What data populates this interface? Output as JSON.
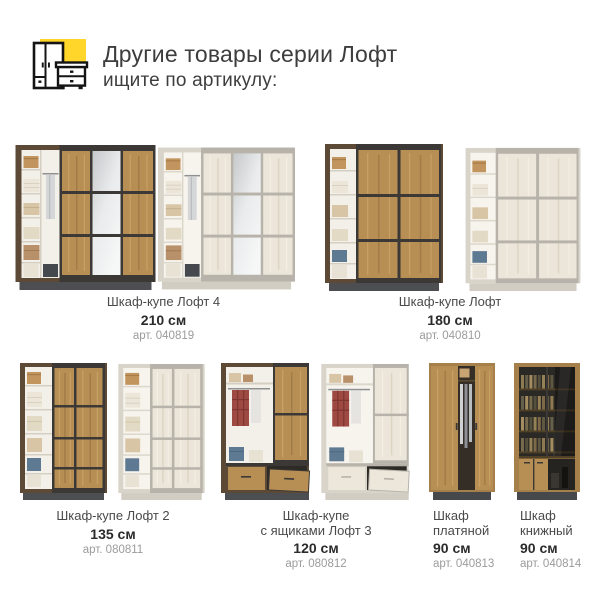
{
  "header": {
    "title": "Другие товары серии Лофт",
    "subtitle": "ищите по артикулу:",
    "icon": "wardrobe-and-dresser-icon"
  },
  "products": [
    {
      "name_lines": [
        "Шкаф-купе Лофт 4"
      ],
      "size": "210 см",
      "article": "арт. 040819"
    },
    {
      "name_lines": [
        "Шкаф-купе Лофт"
      ],
      "size": "180 см",
      "article": "арт. 040810"
    },
    {
      "name_lines": [
        "Шкаф-купе Лофт 2"
      ],
      "size": "135 см",
      "article": "арт. 080811"
    },
    {
      "name_lines": [
        "Шкаф-купе",
        "с ящиками Лофт 3"
      ],
      "size": "120 см",
      "article": "арт. 080812"
    },
    {
      "name_lines": [
        "Шкаф",
        "платяной"
      ],
      "size": "90 см",
      "article": "арт. 040813"
    },
    {
      "name_lines": [
        "Шкаф",
        "книжный"
      ],
      "size": "90 см",
      "article": "арт. 040814"
    }
  ],
  "colors": {
    "accent_yellow": "#ffd629",
    "title_text": "#3d3d3d",
    "name_text": "#4a4a4a",
    "size_text": "#2b2b2b",
    "article_text": "#9b9b9b",
    "oak_wood": "#b78f55",
    "dark_frame": "#5c4936",
    "light_frame": "#d9d4c9"
  }
}
